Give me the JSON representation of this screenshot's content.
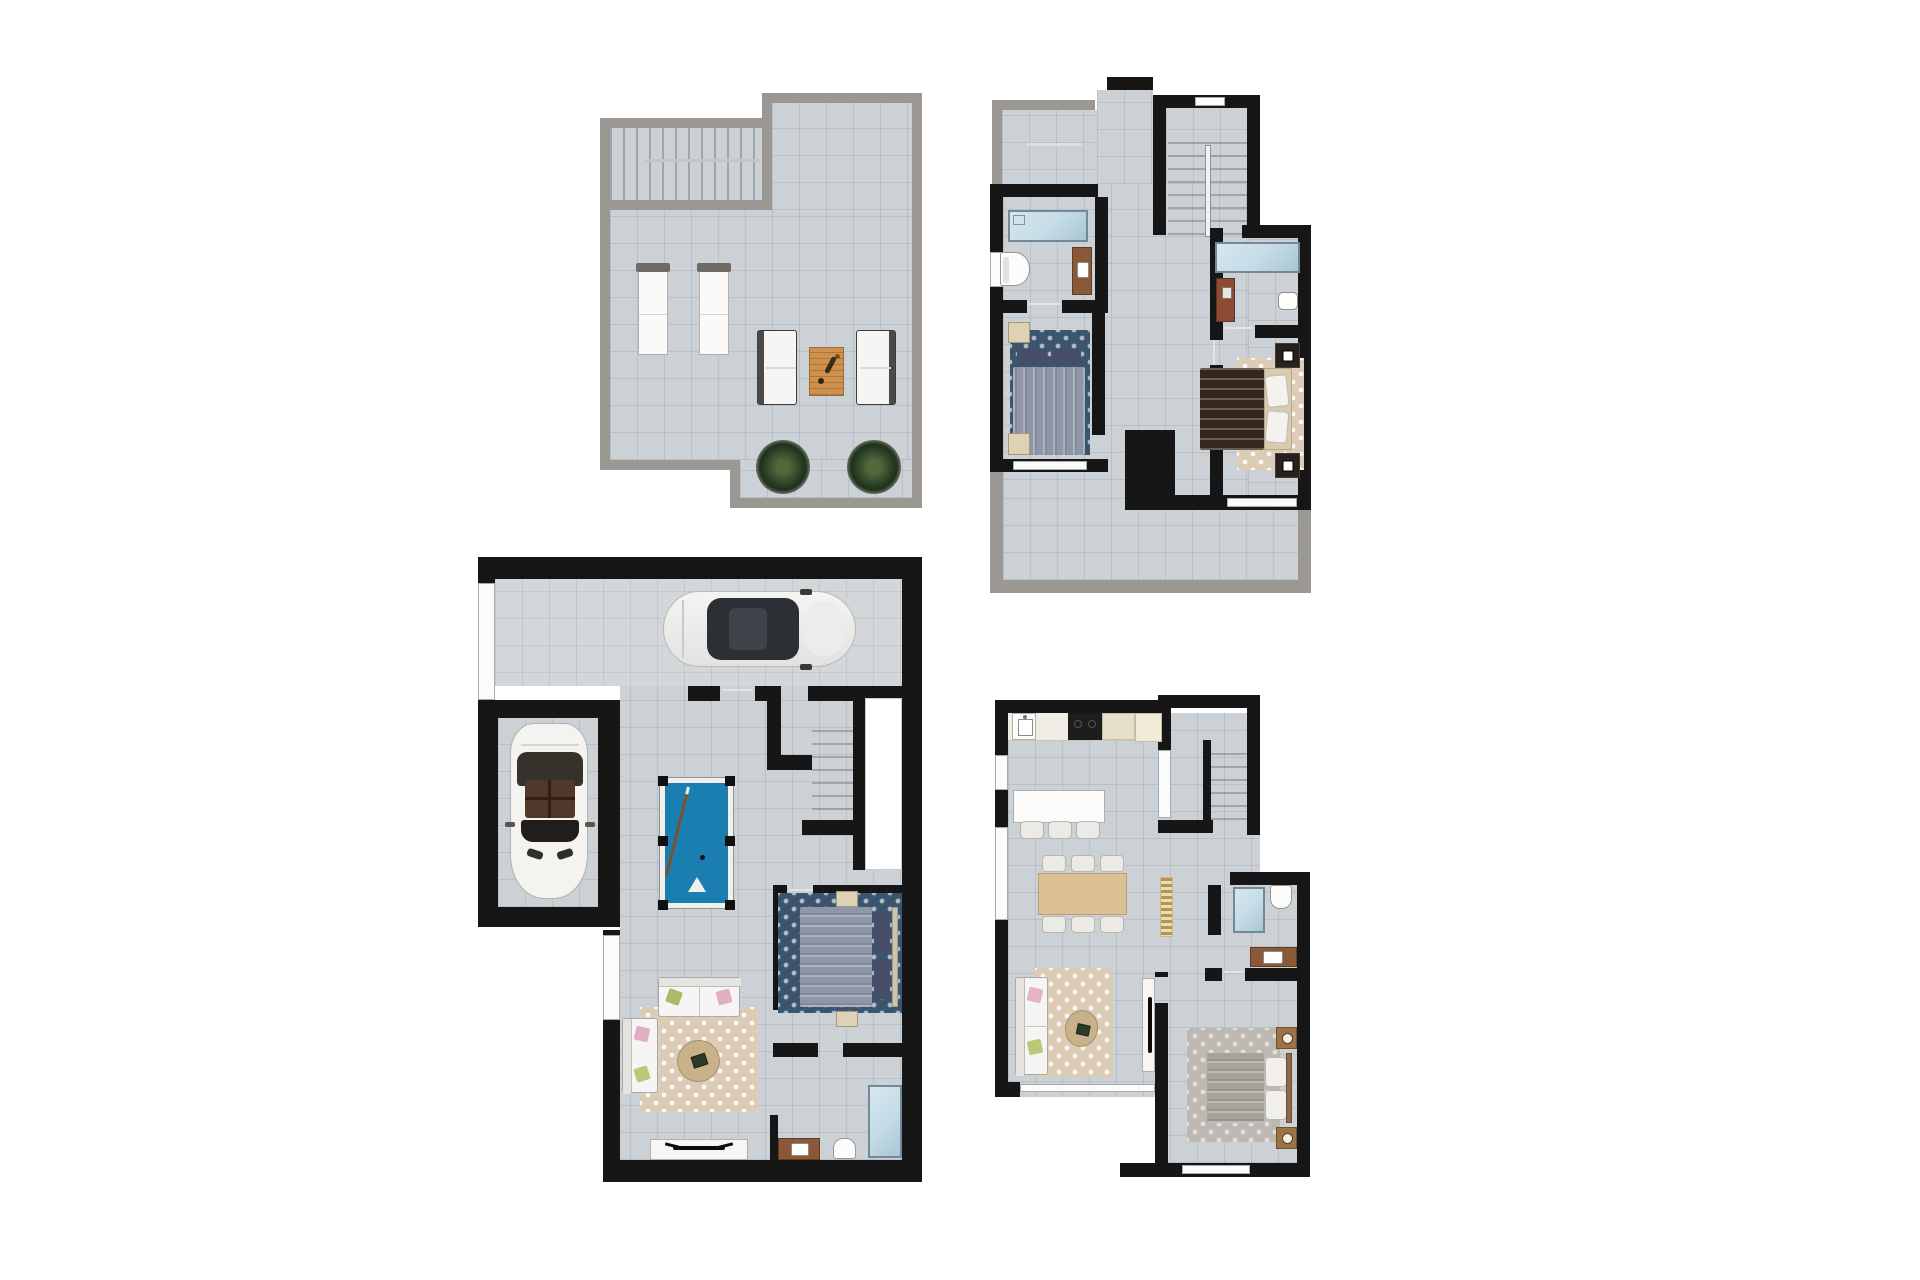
{
  "page": {
    "background": "#ffffff",
    "description": "architectural floor plan sheet, four top-down render plans on white"
  },
  "colors": {
    "wall_black": "#161616",
    "wall_gray": "#9b9792",
    "tile": "#ccd1d6",
    "tile_light": "#d3d7da",
    "pool_felt": "#1a7fb0",
    "rug_navy": "#3c556f",
    "rug_beige": "#dcccb6",
    "rug_gray": "#bdb8b2",
    "wood_table": "#d0914f",
    "wood_dining": "#dcc094",
    "wood_vanity": "#8a5a38",
    "water": "#c4dbe6",
    "duvet_blue": "#8e96a8",
    "pillow_navy": "#474f68",
    "duvet_brown": "#34271c",
    "duvet_gray": "#a8a29a",
    "bed_base_beige": "#d8cbae",
    "plant_green": "#31472c",
    "gold_runner": "#b5964a"
  },
  "plans": [
    {
      "id": "roof-solarium",
      "position": "top-left",
      "rooms": [
        "staircase",
        "open-terrace"
      ],
      "furniture": [
        "sun-lounger",
        "sun-lounger",
        "lounge-chair",
        "wood-coffee-table",
        "lounge-chair",
        "plant",
        "plant"
      ]
    },
    {
      "id": "upper-floor",
      "position": "top-right",
      "rooms": [
        "terrace",
        "bathroom-1",
        "bedroom-1",
        "staircase",
        "bathroom-2",
        "bedroom-2",
        "lower-terrace"
      ],
      "furniture": [
        "bathtub",
        "toilet",
        "vanity-sink",
        "double-bed-navy",
        "shower",
        "shelf",
        "sink",
        "double-bed-brown",
        "nightstands"
      ]
    },
    {
      "id": "basement-garage",
      "position": "bottom-left",
      "rooms": [
        "driveway",
        "garage",
        "games-room",
        "staircase",
        "bedroom",
        "living-room",
        "bathroom"
      ],
      "furniture": [
        "suv-car",
        "convertible-car",
        "billiard-table",
        "double-bed-navy",
        "sofa",
        "sofa",
        "coffee-table",
        "tv-unit",
        "shower",
        "vanity-sink",
        "toilet"
      ]
    },
    {
      "id": "ground-floor",
      "position": "bottom-right",
      "rooms": [
        "kitchen",
        "dining-living",
        "staircase",
        "bathroom",
        "lounge",
        "bedroom"
      ],
      "furniture": [
        "sink-cabinet",
        "cooktop",
        "island-bar",
        "bar-stools",
        "dining-table",
        "dining-chairs",
        "striped-runner",
        "shower",
        "toilet",
        "vanity-sink",
        "sofa",
        "coffee-table",
        "tv-unit",
        "double-bed-gray",
        "nightstand-lamps"
      ]
    }
  ]
}
